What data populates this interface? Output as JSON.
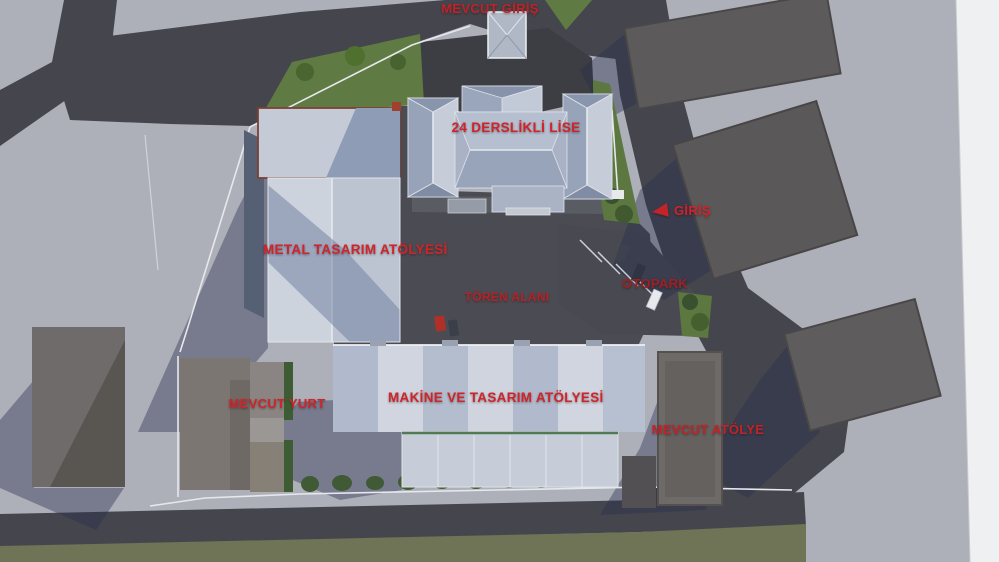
{
  "scene": {
    "type": "aerial-3d-site-plan-render",
    "language": "Turkish"
  },
  "labels": {
    "existing_entrance": "MEVCUT GİRİŞ",
    "school": "24 DERSLİKLİ LİSE",
    "metal_workshop": "METAL TASARIM ATÖLYESİ",
    "entrance": "GİRİŞ",
    "parking": "OTOPARK",
    "ceremony_area": "TÖREN ALANI",
    "existing_dormitory": "MEVCUT YURT",
    "machine_workshop": "MAKİNE VE TASARIM ATÖLYESİ",
    "existing_workshop": "MEVCUT ATÖLYE"
  },
  "icons": {
    "entrance_arrow": "left-arrow"
  },
  "colors": {
    "label_red": "#d0242b",
    "label_red_dark": "#9e2025",
    "pavement": "#adb0b9",
    "asphalt_road": "#45464d",
    "courtyard_asphalt": "#4b4c53",
    "grass": "#5f7b43",
    "grass_strip_olive": "#6e7455",
    "roof_light": "#c7cdd9",
    "roof_shadow": "#97a3b8",
    "existing_building_gray": "#5d5a5c",
    "dormitory_gray": "#7c7673",
    "red_trim": "#7d4034",
    "green_roof_edge": "#4f7a52",
    "white_margin": "#eef0f2"
  }
}
